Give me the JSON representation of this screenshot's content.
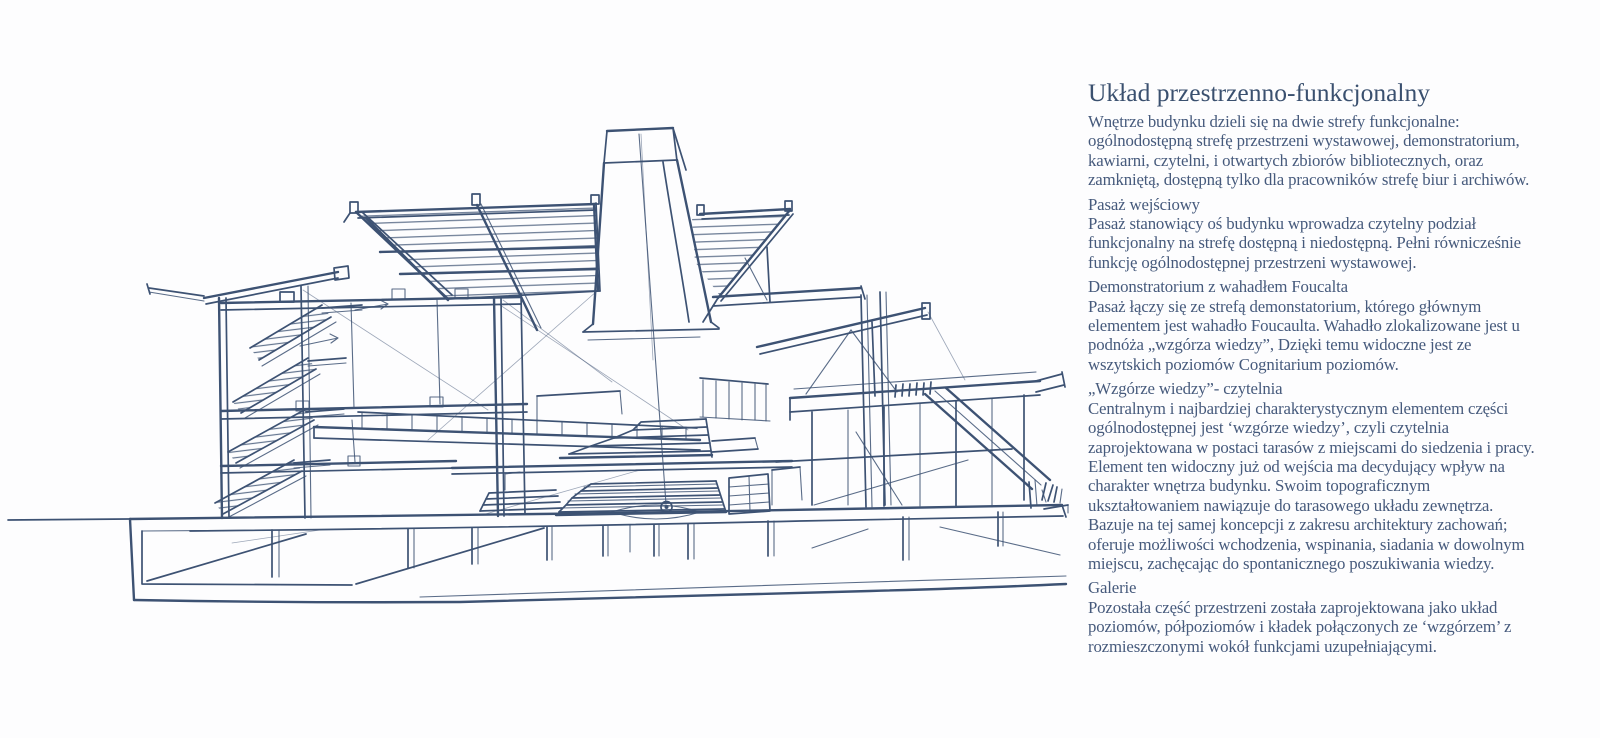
{
  "page": {
    "background": "#fdfdfe",
    "kind": "architecture portfolio page"
  },
  "sketch": {
    "label": "hand-drawn perspective section of the Cognitarium building with Foucault pendulum, knowledge-hill terraces, stairs, canopies and pilotis",
    "ink_color": "#3d5273"
  },
  "article": {
    "title": "Układ przestrzenno-funkcjonalny",
    "text_color": "#465a7c",
    "sections": [
      {
        "heading": null,
        "body": "Wnętrze budynku dzieli się na dwie strefy funkcjonalne: ogólnodostępną strefę przestrzeni wystawowej, demonstratorium, kawiarni, czytelni, i otwartych zbiorów bibliotecznych, oraz zamkniętą, dostępną tylko dla pracowników strefę biur i archiwów."
      },
      {
        "heading": "Pasaż wejściowy",
        "body": "Pasaż stanowiący oś budynku wprowadza czytelny podział funkcjonalny na strefę dostępną i niedostępną. Pełni równicześnie funkcję ogólnodostępnej przestrzeni wystawowej."
      },
      {
        "heading": "Demonstratorium z wahadłem Foucalta",
        "body": "Pasaż łączy się ze strefą demonstatorium, którego głównym elementem jest wahadło Foucaulta. Wahadło zlokalizowane jest u podnóża „wzgórza wiedzy”, Dzięki temu widoczne jest ze wszytskich poziomów Cognitarium poziomów."
      },
      {
        "heading": "„Wzgórze wiedzy”- czytelnia",
        "body": "Centralnym i najbardziej charakterystycznym elementem części ogólnodostępnej jest ‘wzgórze wiedzy’, czyli czytelnia zaprojektowana w postaci tarasów z miejscami do siedzenia i pracy. Element ten widoczny już od wejścia ma decydujący wpływ na charakter wnętrza budynku. Swoim topograficznym ukształtowaniem nawiązuje do tarasowego układu zewnętrza. Bazuje na tej samej koncepcji z zakresu architektury zachowań; oferuje możliwości wchodzenia, wspinania, siadania w dowolnym miejscu, zachęcając do spontanicznego poszukiwania wiedzy."
      },
      {
        "heading": "Galerie",
        "body": "Pozostała część przestrzeni została zaprojektowana jako układ poziomów, półpoziomów i kładek połączonych ze ‘wzgórzem’ z rozmieszczonymi wokół funkcjami uzupełniającymi."
      }
    ]
  }
}
